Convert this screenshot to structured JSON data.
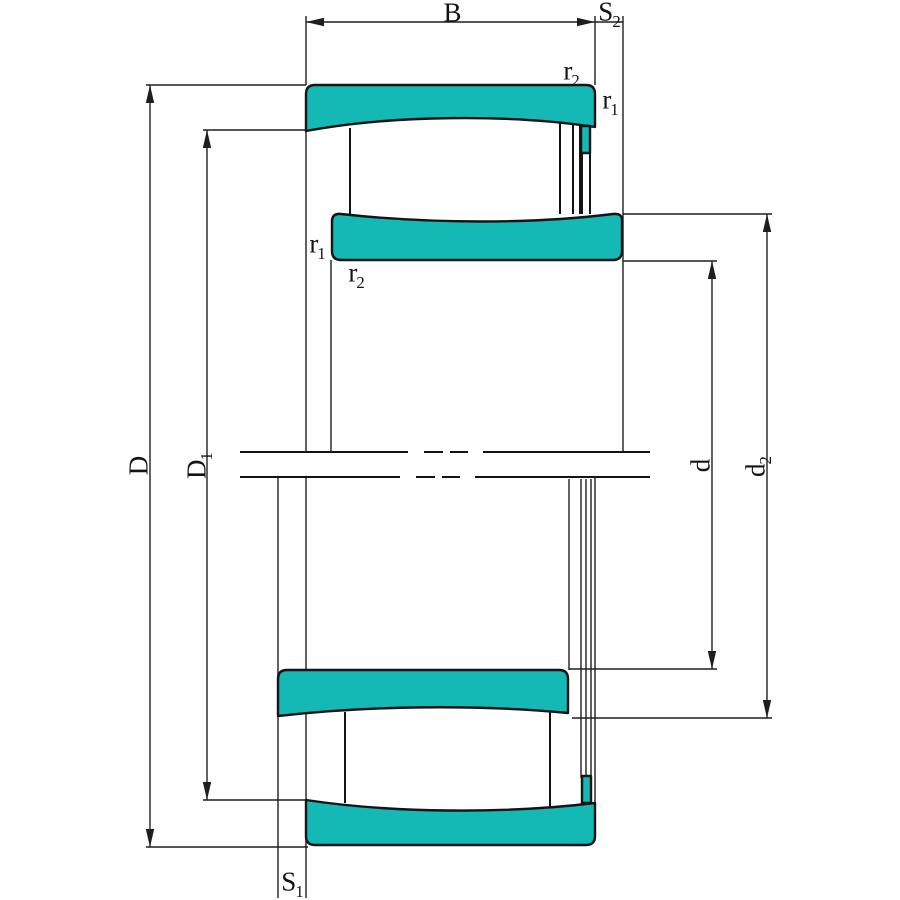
{
  "labels": {
    "B": {
      "base": "B",
      "sub": ""
    },
    "S2": {
      "base": "S",
      "sub": "2"
    },
    "r2_top": {
      "base": "r",
      "sub": "2"
    },
    "r1_top": {
      "base": "r",
      "sub": "1"
    },
    "r1_left": {
      "base": "r",
      "sub": "1"
    },
    "r2_left": {
      "base": "r",
      "sub": "2"
    },
    "D": {
      "base": "D",
      "sub": ""
    },
    "D1": {
      "base": "D",
      "sub": "1"
    },
    "d": {
      "base": "d",
      "sub": ""
    },
    "d2": {
      "base": "d",
      "sub": "2"
    },
    "S1": {
      "base": "S",
      "sub": "1"
    }
  },
  "colors": {
    "ring_fill": "#14b8b4",
    "outline": "#141414",
    "dimension": "#1e1e1e",
    "background": "#ffffff"
  }
}
